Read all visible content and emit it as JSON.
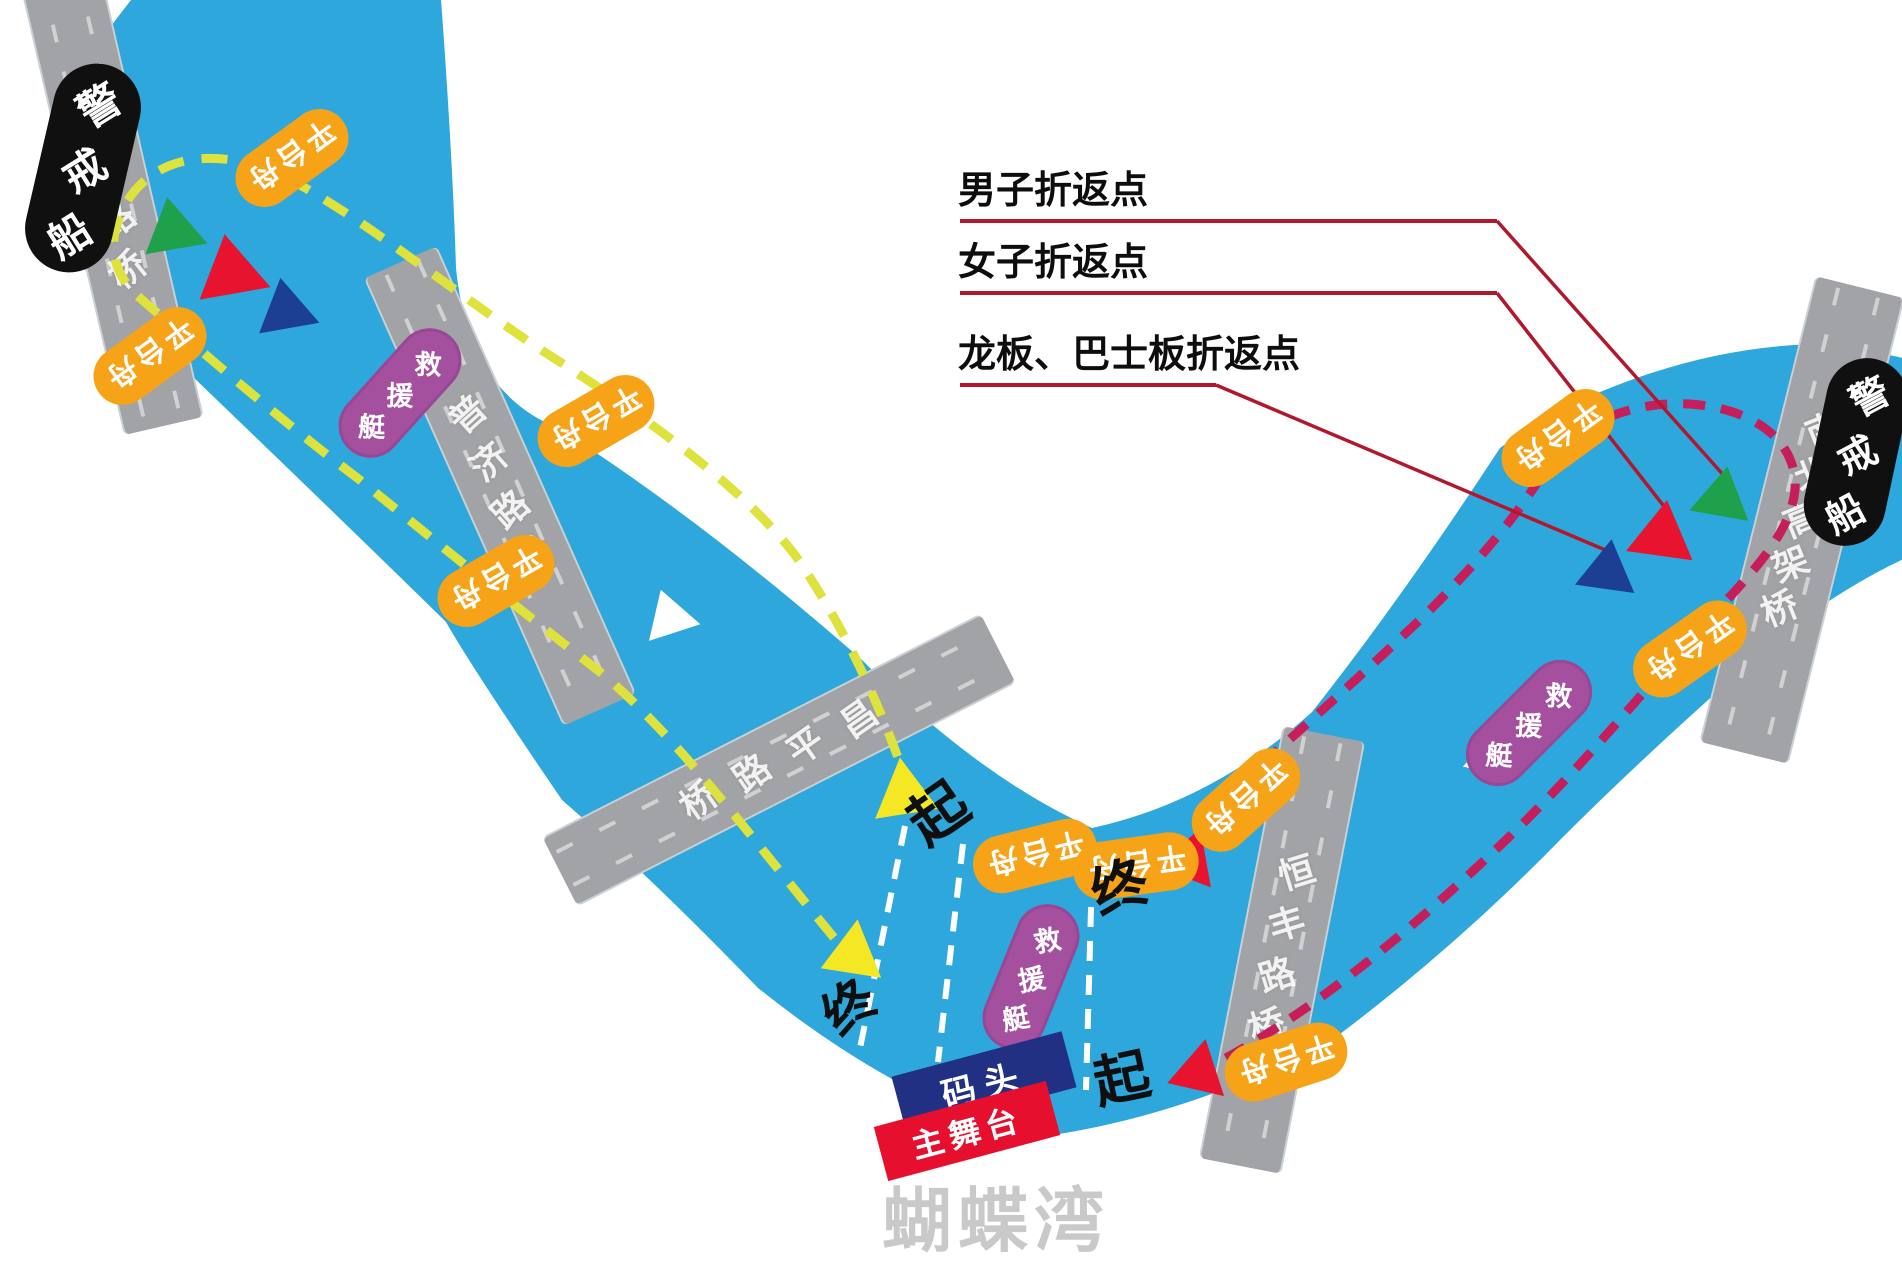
{
  "map_title": "蝴蝶湾",
  "bridges": [
    {
      "name": "安远路桥"
    },
    {
      "name": "普济路桥"
    },
    {
      "name": "昌平路桥"
    },
    {
      "name": "恒丰路桥"
    },
    {
      "name": "南北高架桥"
    }
  ],
  "boats": {
    "patrol": "警戒船",
    "platform": "平台舟",
    "rescue": "救援艇"
  },
  "turnaround_labels": [
    {
      "label": "男子折返点"
    },
    {
      "label": "女子折返点"
    },
    {
      "label": "龙板、巴士板折返点"
    }
  ],
  "markers": {
    "start": "起",
    "finish": "终"
  },
  "venues": {
    "dock": "码头",
    "main_stage": "主舞台",
    "bay": "蝴蝶湾"
  },
  "legend_colors": {
    "river": "#2ea7dc",
    "bridge": "#a2a3a6",
    "yellow_route": "#dde23c",
    "red_route": "#c51e5a",
    "leader_line": "#b2182b",
    "platform_boat": "#f6a318",
    "rescue_boat": "#a5509f",
    "patrol_boat": "#101010",
    "dock": "#223084",
    "main_stage": "#e60f2e",
    "triangle_green": "#1fa14b",
    "triangle_red": "#e8132f",
    "triangle_blue": "#1c3e93",
    "triangle_yellow": "#f3e823"
  }
}
